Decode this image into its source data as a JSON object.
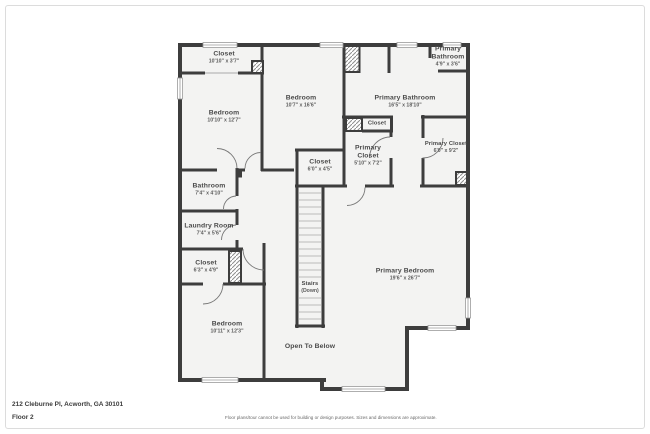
{
  "colors": {
    "wall": "#3d3d3d",
    "room_fill": "#f3f3f2",
    "label": "#4a4a4a"
  },
  "rooms": [
    {
      "id": "closet-tl",
      "name": "Closet",
      "dims": "10'10\" x 3'7\""
    },
    {
      "id": "bedroom-tl",
      "name": "Bedroom",
      "dims": "10'10\" x 12'7\""
    },
    {
      "id": "bedroom-center",
      "name": "Bedroom",
      "dims": "10'7\" x 16'6\""
    },
    {
      "id": "primary-bathroom",
      "name": "Primary Bathroom",
      "dims": "16'5\" x 18'10\""
    },
    {
      "id": "primary-bathroom-small",
      "name": "Primary Bathroom",
      "dims": "4'9\" x 3'6\""
    },
    {
      "id": "closet-mid",
      "name": "Closet",
      "dims": ""
    },
    {
      "id": "primary-closet-left",
      "name": "Primary Closet",
      "dims": "5'10\" x 7'2\""
    },
    {
      "id": "primary-closet-right",
      "name": "Primary Closet",
      "dims": "6'0\" x 9'2\""
    },
    {
      "id": "closet-center",
      "name": "Closet",
      "dims": "6'0\" x 4'5\""
    },
    {
      "id": "bathroom",
      "name": "Bathroom",
      "dims": "7'4\" x 4'10\""
    },
    {
      "id": "laundry-room",
      "name": "Laundry Room",
      "dims": "7'4\" x 5'6\""
    },
    {
      "id": "closet-bl",
      "name": "Closet",
      "dims": "6'3\" x 4'9\""
    },
    {
      "id": "bedroom-bottom",
      "name": "Bedroom",
      "dims": "10'11\" x 12'3\""
    },
    {
      "id": "stairs",
      "name": "Stairs",
      "dims": "(Down)"
    },
    {
      "id": "open-to-below",
      "name": "Open To Below",
      "dims": ""
    },
    {
      "id": "primary-bedroom",
      "name": "Primary Bedroom",
      "dims": "19'6\" x 26'7\""
    }
  ],
  "footer": {
    "address": "212 Cleburne Pl, Acworth, GA 30101",
    "floor": "Floor 2",
    "disclaimer": "Floor plans/tour cannot be used for building or design purposes. Sizes and dimensions are approximate."
  }
}
